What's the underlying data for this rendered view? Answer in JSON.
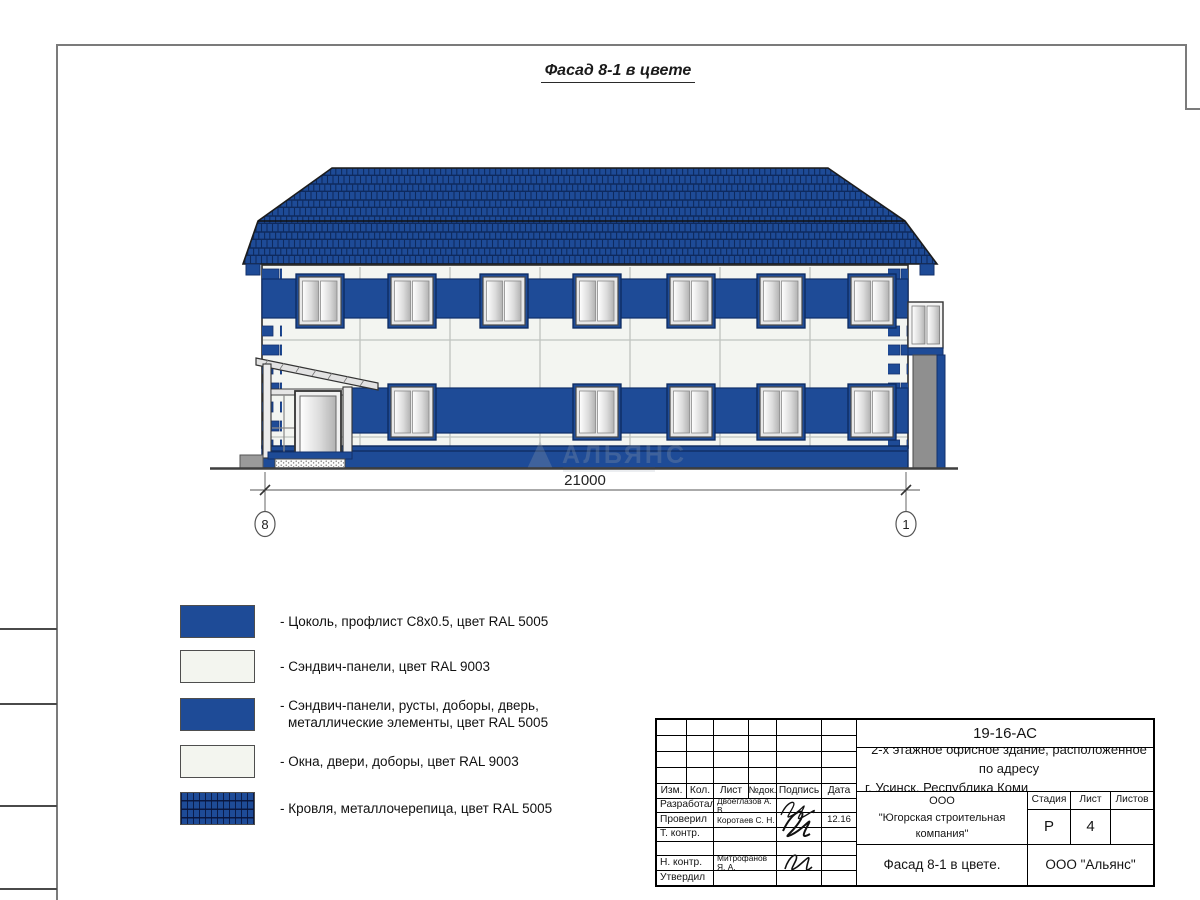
{
  "page": {
    "title": "Фасад 8-1 в цвете"
  },
  "facade": {
    "dimension_label": "21000",
    "axis_left": "8",
    "axis_right": "1",
    "watermark_text": "АЛЬЯНС"
  },
  "legend": {
    "items": [
      {
        "label": "- Цоколь, профлист С8х0.5, цвет RAL 5005"
      },
      {
        "label": "- Сэндвич-панели, цвет RAL 9003"
      },
      {
        "label": "- Сэндвич-панели, русты, доборы, дверь,",
        "label2": "металлические элементы, цвет RAL 5005"
      },
      {
        "label": "- Окна, двери, доборы, цвет RAL 9003"
      },
      {
        "label": "- Кровля, металлочерепица, цвет RAL 5005"
      }
    ]
  },
  "title_block": {
    "doc_number": "19-16-АС",
    "description_line1": "2-х этажное офисное здание, расположенное по адресу",
    "description_line2": "г. Усинск, Республика Коми",
    "columns": {
      "izm": "Изм.",
      "kol": "Кол.",
      "list": "Лист",
      "ndok": "№док.",
      "podpis": "Подпись",
      "data": "Дата"
    },
    "rows": [
      {
        "role": "Разработал",
        "name": "Двоеглазов А. В.",
        "date": ""
      },
      {
        "role": "Проверил",
        "name": "Коротаев С. Н.",
        "date": "12.16"
      },
      {
        "role": "Т. контр.",
        "name": "",
        "date": ""
      },
      {
        "role": "",
        "name": "",
        "date": ""
      },
      {
        "role": "Н. контр.",
        "name": "Митрофанов Я. А.",
        "date": ""
      },
      {
        "role": "Утвердил",
        "name": "",
        "date": ""
      }
    ],
    "company_line1": "ООО",
    "company_line2": "\"Югорская строительная компания\"",
    "stage_label": "Стадия",
    "sheet_label": "Лист",
    "sheets_label": "Листов",
    "stage_value": "Р",
    "sheet_value": "4",
    "sheets_value": "",
    "drawing_title": "Фасад 8-1 в цвете.",
    "org_name": "ООО \"Альянс\""
  },
  "colors": {
    "ral5005_blue": "#1e4b97",
    "ral9003_white": "#f3f5ef"
  }
}
